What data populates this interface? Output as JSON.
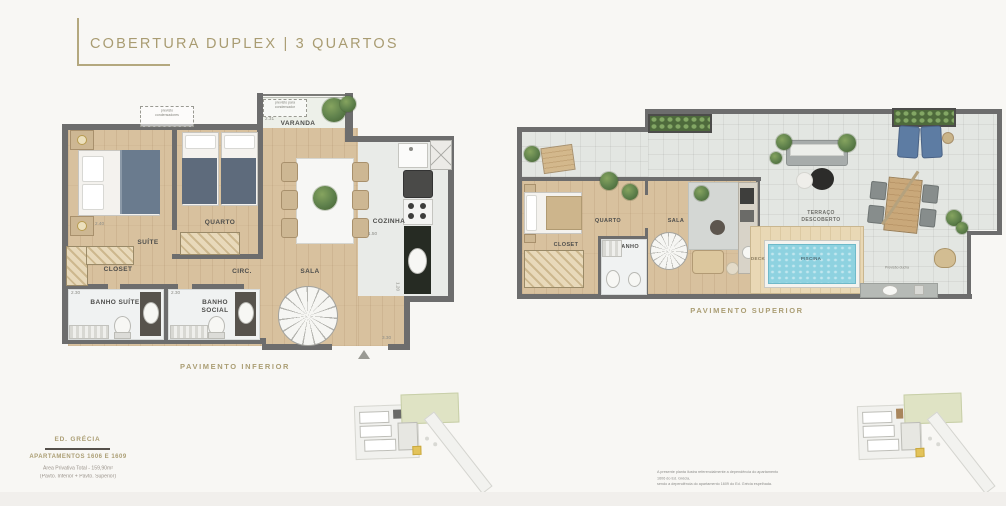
{
  "palette": {
    "accent_gold": "#ab9e74",
    "wall_gray": "#6d6d6d",
    "wood_floor": "#d8c19e",
    "terrace_floor": "#e3e6e2",
    "pool_water": "#8ed2e0",
    "deck_wood": "#e7d6b2",
    "plant_green": "#5d7f4b",
    "marker_gold": "#e3c35a"
  },
  "header": {
    "title": "COBERTURA DUPLEX | 3 QUARTOS"
  },
  "lower_plan": {
    "caption": "PAVIMENTO INFERIOR",
    "rooms": {
      "varanda": "VARANDA",
      "suite": "SUÍTE",
      "quarto": "QUARTO",
      "closet": "CLOSET",
      "circ": "CIRC.",
      "banho_suite": "BANHO SUÍTE",
      "banho_social": "BANHO SOCIAL",
      "sala": "SALA",
      "cozinha": "COZINHA"
    },
    "notes": {
      "condenser_top": "previsto condensadores",
      "condenser_varanda": "previsto para condensador"
    },
    "dims": {
      "varanda_w": "2.31",
      "varanda_d": "0.90",
      "suite_w": "2.40",
      "banho_suite_w": "2.30",
      "banho_social_w": "2.30",
      "cozinha_w": "1.50",
      "cozinha_d": "1.20",
      "sala_door": "3.30"
    }
  },
  "upper_plan": {
    "caption": "PAVIMENTO SUPERIOR",
    "rooms": {
      "quarto": "QUARTO",
      "closet": "CLOSET",
      "banho": "BANHO",
      "sala": "SALA",
      "terraco_line1": "TERRAÇO",
      "terraco_line2": "DESCOBERTO",
      "deck": "DECK",
      "piscina": "PISCINA"
    },
    "notes": {
      "previsao": "Previsão ducha"
    }
  },
  "info": {
    "building": "ED. GRÉCIA",
    "units": "APARTAMENTOS 1606 E 1609",
    "area": "Área Privativa Total - 159,90m²",
    "floors": "(Pavto. Inferior + Pavto. Superior)"
  },
  "disclaimer": {
    "line1": "A presente planta ilustra referencialmente a dependência do apartamento 1606 do Ed. Grécia,",
    "line2": "sendo a dependência do apartamento 1609 do Ed. Grécia espelhada."
  }
}
